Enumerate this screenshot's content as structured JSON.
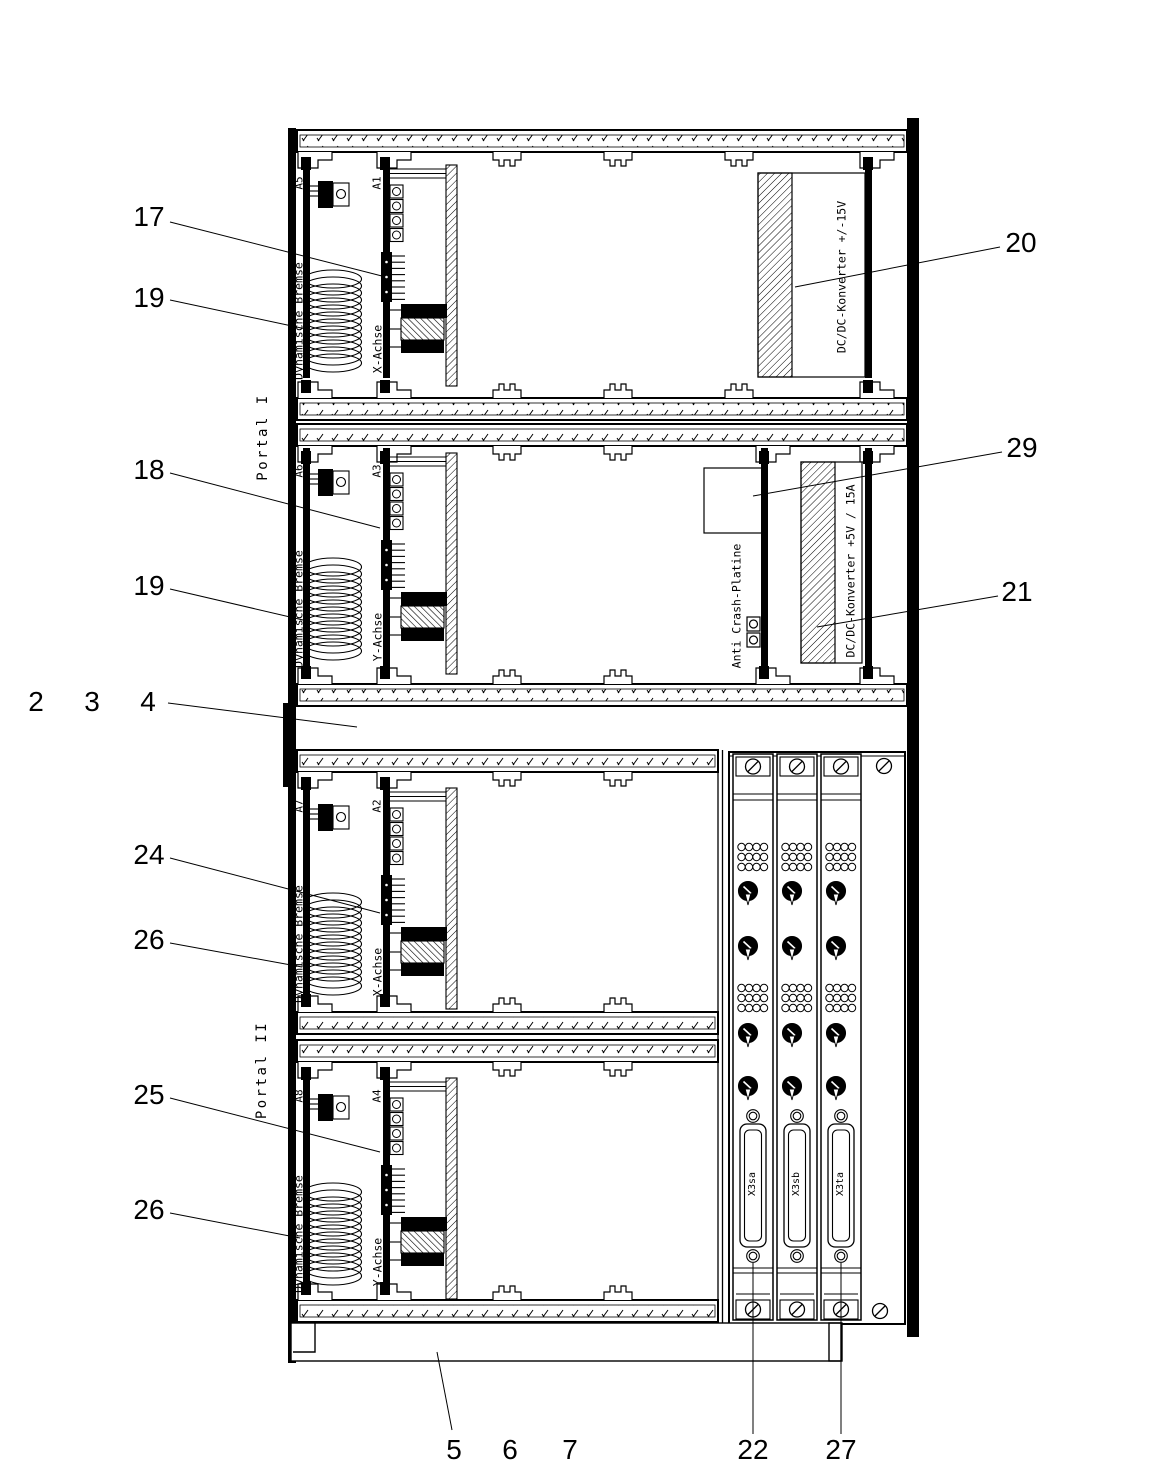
{
  "labels": {
    "portal_1": "Portal I",
    "portal_2": "Portal II",
    "dynamische_bremse": "Dynamische Bremse",
    "x_achse": "X-Achse",
    "y_achse": "Y-Achse",
    "a1": "A1",
    "a2": "A2",
    "a3": "A3",
    "a4": "A4",
    "a5": "A5",
    "a6": "A6",
    "a7": "A7",
    "a8": "A8",
    "dcdc_15v": "DC/DC-Konverter +/-15V",
    "anti_crash": "Anti Crash-Platine",
    "dcdc_5v": "DC/DC-Konverter +5V / 15A",
    "x3sa": "X3sa",
    "x3sb": "X3sb",
    "x3ta": "X3ta"
  },
  "ref_numbers": {
    "n2": "2",
    "n3": "3",
    "n4": "4",
    "n5": "5",
    "n6": "6",
    "n7": "7",
    "n17": "17",
    "n18": "18",
    "n19": "19",
    "n20": "20",
    "n21": "21",
    "n22": "22",
    "n24": "24",
    "n25": "25",
    "n26": "26",
    "n27": "27",
    "n29": "29"
  },
  "colors": {
    "ink": "#000000",
    "paper": "#ffffff"
  }
}
